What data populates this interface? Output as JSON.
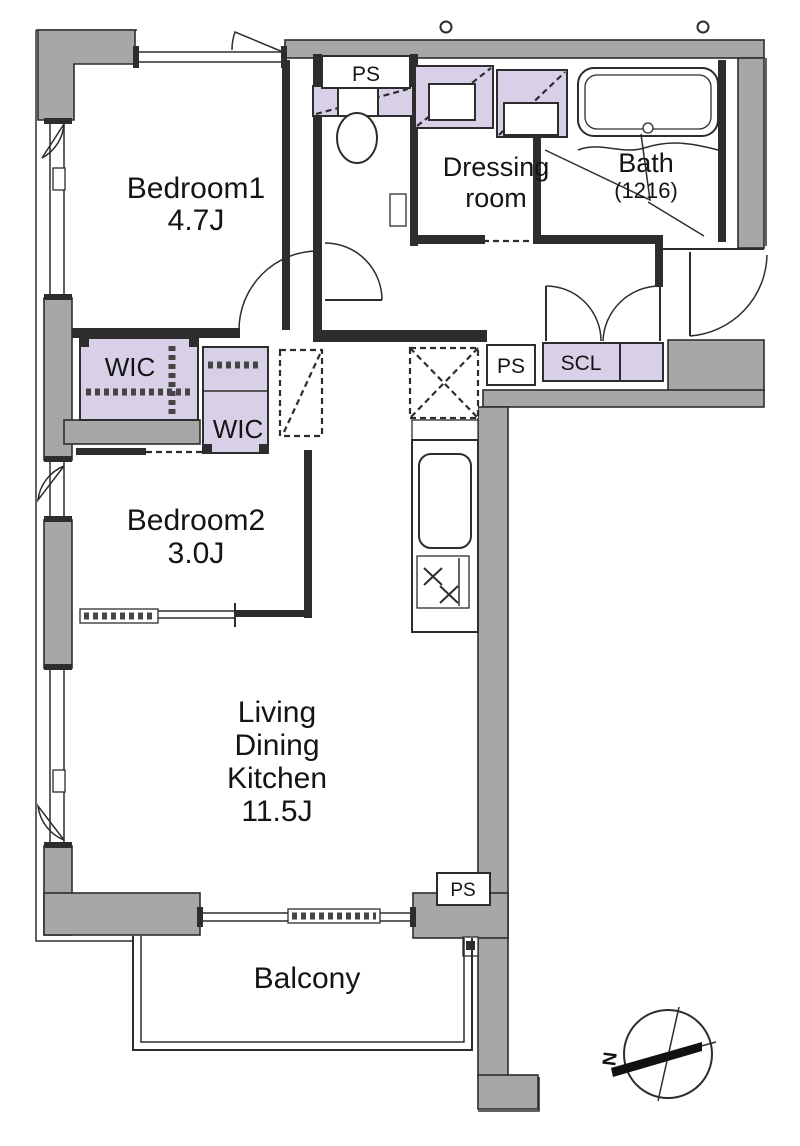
{
  "colors": {
    "wall": "#a7a7a7",
    "closet": "#d7d0e7",
    "line": "#2d2d2d",
    "paper": "#ffffff"
  },
  "rooms": {
    "bedroom1": {
      "name": "Bedroom1",
      "size": "4.7J"
    },
    "bedroom2": {
      "name": "Bedroom2",
      "size": "3.0J"
    },
    "ldk": {
      "line1": "Living",
      "line2": "Dining",
      "line3": "Kitchen",
      "size": "11.5J"
    },
    "dressing_room": {
      "line1": "Dressing",
      "line2": "room"
    },
    "bath": {
      "name": "Bath",
      "size": "(1216)"
    },
    "balcony": {
      "name": "Balcony"
    }
  },
  "closets": {
    "wic1": "WIC",
    "wic2": "WIC",
    "scl": "SCL"
  },
  "utilities": {
    "ps_top": "PS",
    "ps_middle": "PS",
    "ps_bottom": "PS"
  },
  "compass": {
    "north": "N"
  }
}
